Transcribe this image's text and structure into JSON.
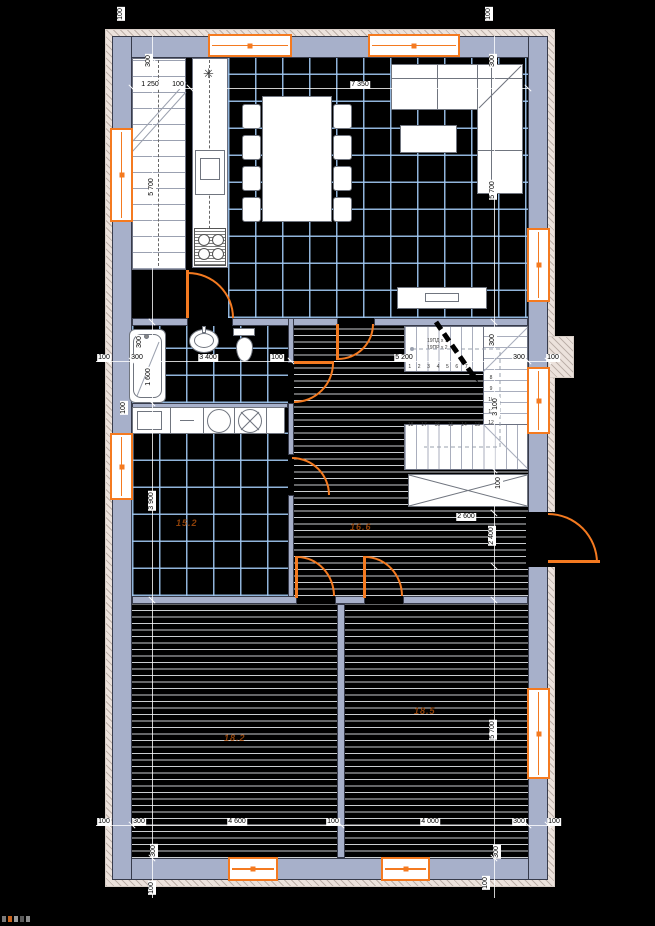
{
  "dims": {
    "h1": "1 250",
    "h2": "100",
    "h3": "7 350",
    "h4": "100",
    "h5": "300",
    "h6": "3 400",
    "h7": "100",
    "h8": "5 200",
    "h9": "300",
    "h10": "100",
    "h11": "2 600",
    "h12": "100",
    "h13": "300",
    "h14": "4 600",
    "h15": "100",
    "h16": "4 000",
    "h17": "300",
    "h18": "100",
    "v1": "100",
    "v2": "300",
    "v3": "5 700",
    "v4": "300",
    "v5": "1 600",
    "v6": "100",
    "v7": "3 900",
    "v8": "300",
    "v9": "100",
    "v10": "100",
    "v11": "300",
    "v12": "5 700",
    "v13": "300",
    "v14": "3 100",
    "v15": "100",
    "v16": "2 400",
    "v17": "5 700",
    "v18": "300",
    "v19": "100"
  },
  "stairs": {
    "note1": "19ПД x 1",
    "note2": "19ПР x 2",
    "top_numbers": [
      "1",
      "2",
      "3",
      "4",
      "5",
      "6",
      "7"
    ],
    "right_numbers": [
      "8",
      "9",
      "10",
      "11",
      "12"
    ],
    "bottom_numbers": [
      "18",
      "17",
      "16",
      "15",
      "14",
      "13"
    ]
  },
  "rooms": {
    "utility_area": "15.2",
    "hall_area": "16.6",
    "bedroom1_area": "18.2",
    "bedroom2_area": "18.5"
  },
  "kitchen": {
    "extractor_symbol": "✳"
  },
  "colors": {
    "accent": "#f47a20",
    "wall": "#a7b0ca",
    "tile_grid": "#a0c8f2"
  }
}
